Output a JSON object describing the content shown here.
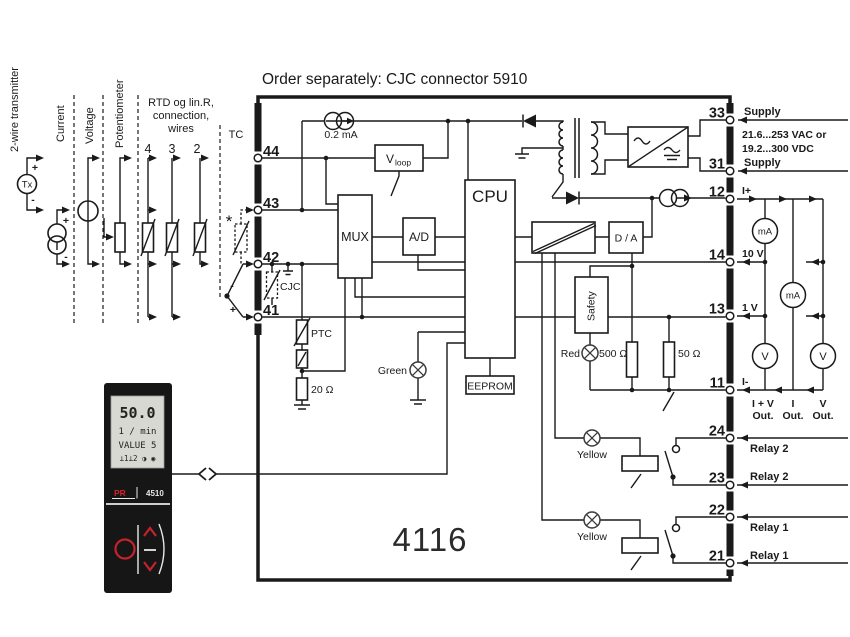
{
  "header": {
    "title": "Order separately: CJC connector 5910"
  },
  "device": {
    "model": "4116"
  },
  "inputs": {
    "transmitter": "2-wire transmitter",
    "current": "Current",
    "voltage": "Voltage",
    "potentiometer": "Potentiometer",
    "rtd_line1": "RTD og lin.R,",
    "rtd_line2": "connection,",
    "rtd_line3": "wires",
    "wire_4": "4",
    "wire_3": "3",
    "wire_2": "2",
    "tc": "TC",
    "star": "*",
    "tx": "Tx",
    "plus": "+",
    "minus": "-"
  },
  "terminals": {
    "t44": "44",
    "t43": "43",
    "t42": "42",
    "t41": "41",
    "t33": "33",
    "t31": "31",
    "t12": "12",
    "t14": "14",
    "t13": "13",
    "t11": "11",
    "t24": "24",
    "t23": "23",
    "t22": "22",
    "t21": "21"
  },
  "right": {
    "supply_top": "Supply",
    "range1": "21.6...253 VAC or",
    "range2": "19.2...300 VDC",
    "supply_bottom": "Supply",
    "i_plus": "I+",
    "v10": "10 V",
    "v1": "1 V",
    "i_minus": "I-",
    "out1": "I + V",
    "out2": "I",
    "out3": "V",
    "out_suffix": "Out.",
    "relay2": "Relay 2",
    "relay1": "Relay 1"
  },
  "blocks": {
    "mux": "MUX",
    "ad": "A/D",
    "cpu": "CPU",
    "eeprom": "EEPROM",
    "vloop_main": "V",
    "vloop_sub": "loop",
    "safety": "Safety",
    "da": "D / A"
  },
  "parts": {
    "source": "0.2 mA",
    "cjc": "CJC",
    "ptc": "PTC",
    "r20": "20 Ω",
    "r500": "500 Ω",
    "r50": "50 Ω"
  },
  "leds": {
    "green": "Green",
    "red": "Red",
    "yellow": "Yellow"
  },
  "meters": {
    "ma": "mA",
    "v": "V"
  },
  "panel": {
    "value": "50.0",
    "unit": "1 / min",
    "line3": "VALUE 5",
    "icons": "⊥1⊥2 ◑ ◉",
    "brand": "PR",
    "model": "4510"
  }
}
